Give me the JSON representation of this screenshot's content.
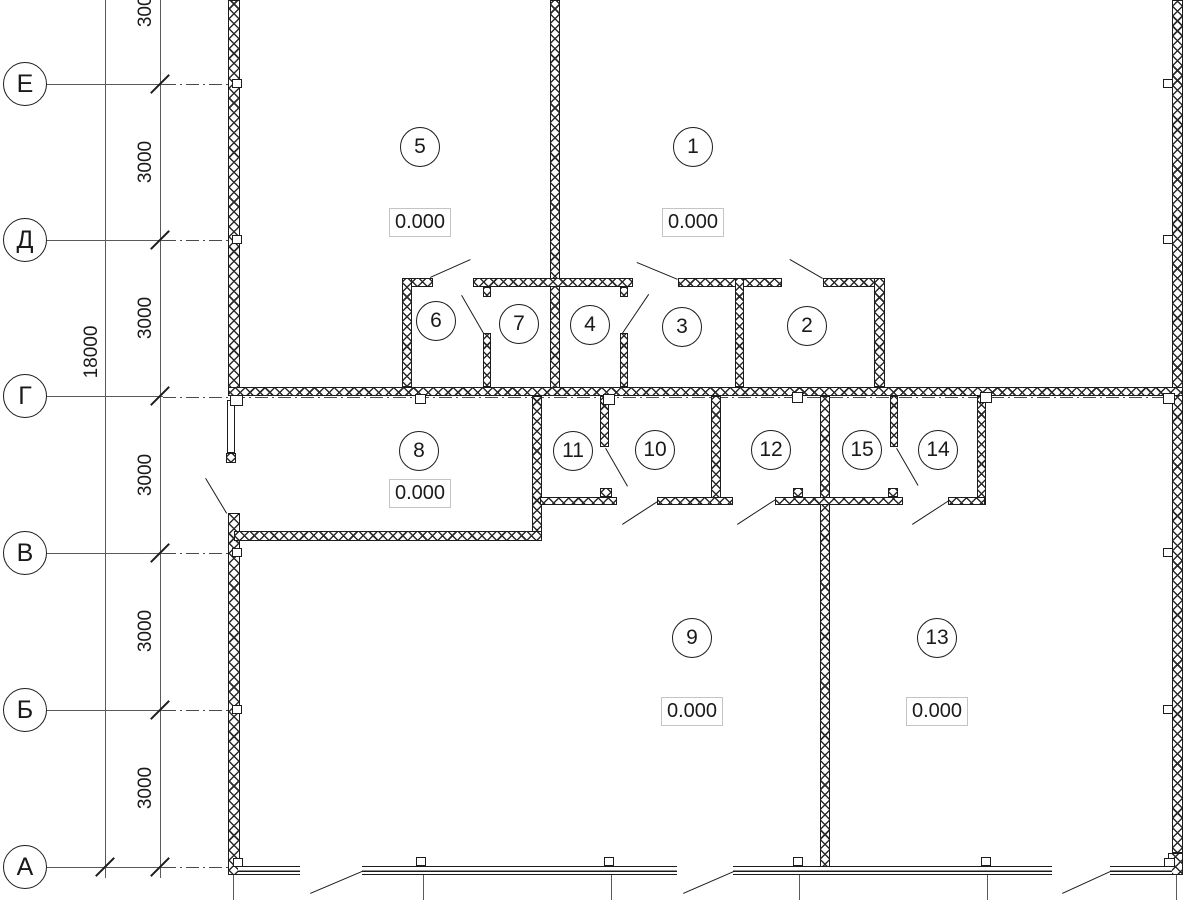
{
  "plan": {
    "axis_rows": [
      {
        "label": "Е"
      },
      {
        "label": "Д"
      },
      {
        "label": "Г"
      },
      {
        "label": "В"
      },
      {
        "label": "Б"
      },
      {
        "label": "А"
      }
    ],
    "dimensions": {
      "segments": [
        "3000",
        "3000",
        "3000",
        "3000",
        "3000",
        "3000"
      ],
      "total": "18000"
    },
    "rooms": [
      {
        "number": "1",
        "elevation": "0.000"
      },
      {
        "number": "2"
      },
      {
        "number": "3"
      },
      {
        "number": "4"
      },
      {
        "number": "5",
        "elevation": "0.000"
      },
      {
        "number": "6"
      },
      {
        "number": "7"
      },
      {
        "number": "8",
        "elevation": "0.000"
      },
      {
        "number": "9",
        "elevation": "0.000"
      },
      {
        "number": "10"
      },
      {
        "number": "11"
      },
      {
        "number": "12"
      },
      {
        "number": "13",
        "elevation": "0.000"
      },
      {
        "number": "14"
      },
      {
        "number": "15"
      }
    ],
    "colors": {
      "line": "#1c1c1c",
      "axis_line": "#555555",
      "elevation_box_border": "#c4c4c4",
      "background": "#ffffff"
    }
  }
}
